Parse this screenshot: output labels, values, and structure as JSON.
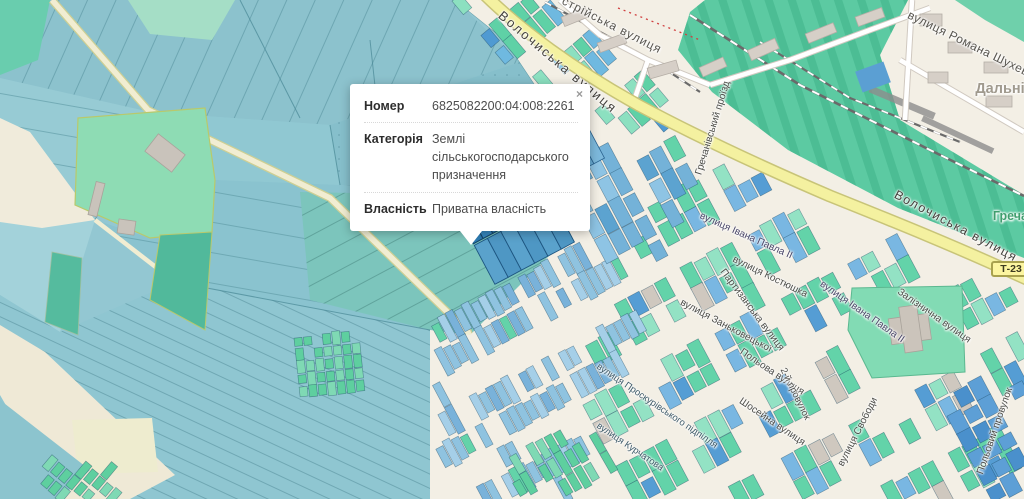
{
  "popup": {
    "close_label": "×",
    "rows": [
      {
        "label": "Номер",
        "value": "6825082200:04:008:2261"
      },
      {
        "label": "Категорія",
        "value": "Землі сільськогосподарського призначення"
      },
      {
        "label": "Власність",
        "value": "Приватна власність"
      }
    ]
  },
  "road_shield": {
    "text": "Т-23"
  },
  "place_labels": [
    {
      "text": "Дальні",
      "x": 1000,
      "y": 89,
      "rot": 0,
      "size": 14.5,
      "color": "#a09a8e",
      "bold": true
    },
    {
      "text": "Гречани",
      "x": 1018,
      "y": 216,
      "rot": 0,
      "size": 12.5,
      "color": "#3f9e6e",
      "bold": true
    }
  ],
  "street_labels": [
    {
      "text": "Волочиська вулиця",
      "x": 558,
      "y": 62,
      "rot": 40,
      "size": 13,
      "ls": 2,
      "color": "#44413c"
    },
    {
      "text": "Волочиська вулиця",
      "x": 956,
      "y": 226,
      "rot": 28,
      "size": 12.5,
      "ls": 1.5,
      "color": "#44413c"
    },
    {
      "text": "стрійська вулиця",
      "x": 612,
      "y": 25,
      "rot": 27,
      "size": 12,
      "ls": 1,
      "color": "#57544e"
    },
    {
      "text": "вулиця Романа Шухевича",
      "x": 978,
      "y": 48,
      "rot": 26,
      "size": 12,
      "ls": 0.5,
      "color": "#57544e"
    },
    {
      "text": "Гречанівський проїзд",
      "x": 713,
      "y": 128,
      "rot": -73,
      "size": 10,
      "ls": 0,
      "color": "#4c4c48"
    },
    {
      "text": "вулиця Івана Павла ІІ",
      "x": 746,
      "y": 236,
      "rot": 24,
      "size": 10,
      "ls": 0,
      "color": "#4a4668"
    },
    {
      "text": "вулиця Костюшка",
      "x": 770,
      "y": 277,
      "rot": 26,
      "size": 10,
      "ls": 0,
      "color": "#4c4c48"
    },
    {
      "text": "Партизанська вулиця",
      "x": 752,
      "y": 310,
      "rot": 53,
      "size": 10,
      "ls": 0,
      "color": "#4c4c48"
    },
    {
      "text": "вулиця Заньковецької",
      "x": 726,
      "y": 326,
      "rot": 28,
      "size": 10,
      "ls": 0,
      "color": "#4c4c48"
    },
    {
      "text": "вулиця Івана Павла ІІ",
      "x": 862,
      "y": 312,
      "rot": 35,
      "size": 10,
      "ls": 0,
      "color": "#4a4668"
    },
    {
      "text": "Залізнична вулиця",
      "x": 934,
      "y": 316,
      "rot": 35,
      "size": 10,
      "ls": 0,
      "color": "#4c4c48"
    },
    {
      "text": "Польова вулиця",
      "x": 772,
      "y": 372,
      "rot": 34,
      "size": 10,
      "ls": 0,
      "color": "#4c4c48"
    },
    {
      "text": "2-й провулок",
      "x": 795,
      "y": 394,
      "rot": 64,
      "size": 9.5,
      "ls": 0,
      "color": "#4c4c48"
    },
    {
      "text": "Шосейна вулиця",
      "x": 772,
      "y": 422,
      "rot": 34,
      "size": 10,
      "ls": 0,
      "color": "#4c4c48"
    },
    {
      "text": "вулиця Проскурівського підпілля",
      "x": 657,
      "y": 406,
      "rot": 34,
      "size": 9.5,
      "ls": 0,
      "color": "#3e5a68"
    },
    {
      "text": "вулиця Курчатова",
      "x": 630,
      "y": 447,
      "rot": 34,
      "size": 9.5,
      "ls": 0,
      "color": "#3e5a68"
    },
    {
      "text": "вулиця Свободи",
      "x": 858,
      "y": 432,
      "rot": -63,
      "size": 10,
      "ls": 0,
      "color": "#4c4c48"
    },
    {
      "text": "Польовий провулок",
      "x": 995,
      "y": 431,
      "rot": -71,
      "size": 10,
      "ls": 0,
      "color": "#4c4c48"
    }
  ]
}
